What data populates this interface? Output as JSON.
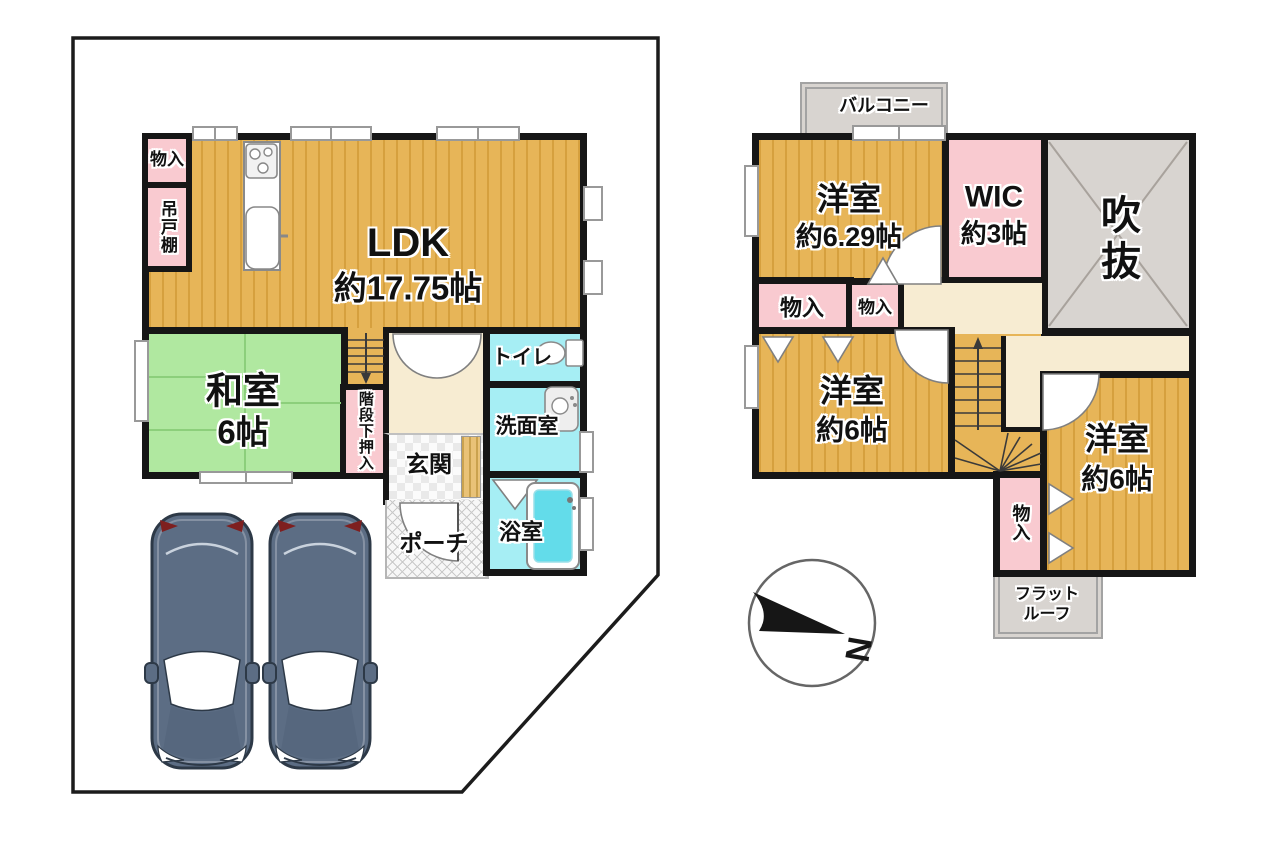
{
  "f1": {
    "storage": "物入",
    "cupboard": "吊戸棚",
    "ldk_name": "LDK",
    "ldk_area": "約17.75帖",
    "washitsu_name": "和室",
    "washitsu_area": "6帖",
    "under_stairs": "階段下押入",
    "toilet": "トイレ",
    "washroom": "洗面室",
    "entrance": "玄関",
    "porch": "ポーチ",
    "bath": "浴室"
  },
  "f2": {
    "balcony": "バルコニー",
    "room1_name": "洋室",
    "room1_area": "約6.29帖",
    "wic_name": "WIC",
    "wic_area": "約3帖",
    "void_label": "吹抜",
    "storage_a": "物入",
    "storage_b": "物入",
    "room2_name": "洋室",
    "room2_area": "約6帖",
    "room3_name": "洋室",
    "room3_area": "約6帖",
    "storage_c": "物入",
    "flat_roof_1": "フラット",
    "flat_roof_2": "ルーフ"
  },
  "compass": {
    "north": "N"
  },
  "colors": {
    "wood": "#e7b558",
    "wood_stripe": "#d6a03e",
    "pink": "#f9cad0",
    "tatami": "#b0e8a0",
    "tatami_line": "#8ccf7b",
    "water": "#a6eef4",
    "hallway": "#f7ecd2",
    "concrete": "#d8d4d0",
    "wall": "#161616",
    "tub": "#63dcea",
    "car_body": "#5c6d84"
  }
}
